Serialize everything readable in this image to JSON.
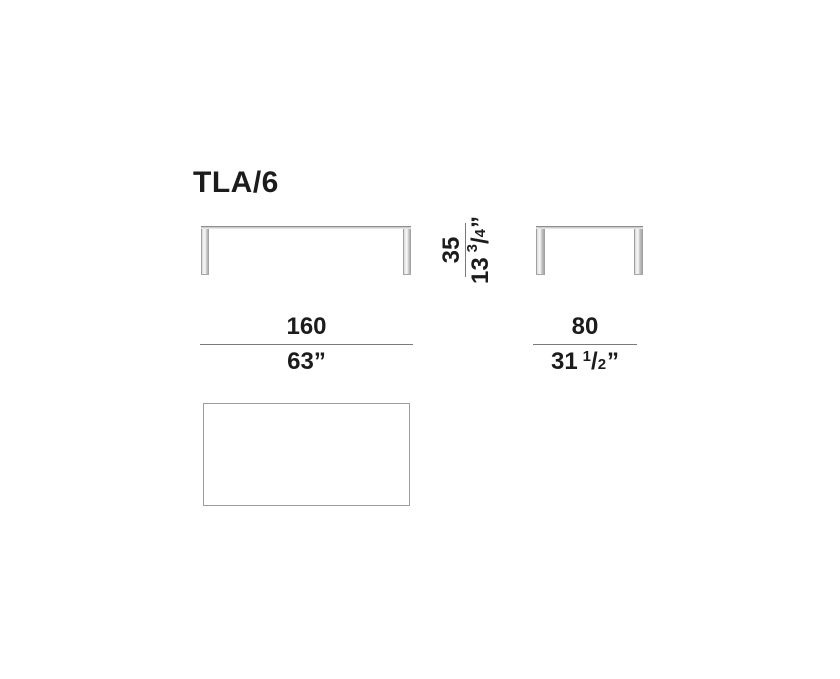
{
  "product": {
    "model": "TLA/6"
  },
  "dimensions": {
    "width": {
      "cm": "160",
      "inch": "63”"
    },
    "depth": {
      "cm": "80",
      "inch_whole": "31",
      "inch_num": "1",
      "inch_slash": "/",
      "inch_den": "2",
      "inch_mark": "”"
    },
    "height": {
      "cm": "35",
      "inch_whole": "13",
      "inch_num": "3",
      "inch_slash": "/",
      "inch_den": "4",
      "inch_mark": "”"
    }
  },
  "colors": {
    "text": "#1c1c1c",
    "dimension_line": "#7a7a7a",
    "surface_edge": "#8f8f8f",
    "surface_fill": "#cccccc",
    "plan_border": "#9c9c9c",
    "background": "#ffffff"
  }
}
